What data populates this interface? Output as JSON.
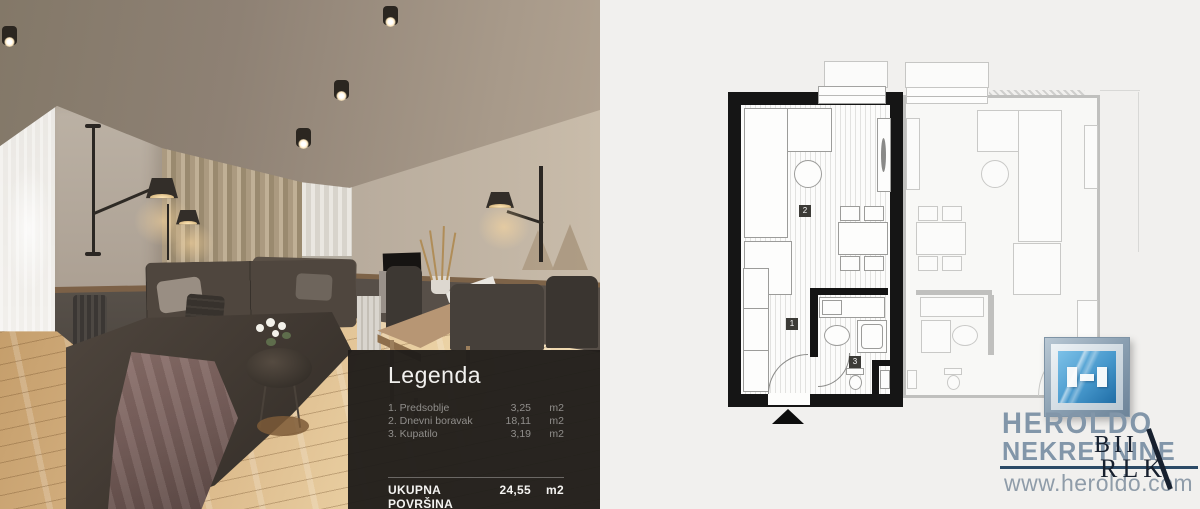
{
  "legend": {
    "title": "Legenda",
    "items": [
      {
        "name": "1. Predsoblje",
        "value": "3,25",
        "unit": "m2"
      },
      {
        "name": "2. Dnevni boravak",
        "value": "18,11",
        "unit": "m2"
      },
      {
        "name": "3. Kupatilo",
        "value": "3,19",
        "unit": "m2"
      }
    ],
    "total_label": "UKUPNA POVRŠINA",
    "total_value": "24,55",
    "total_unit": "m2"
  },
  "floorplan": {
    "labels": {
      "hallway": "1",
      "living": "2",
      "bathroom": "3"
    }
  },
  "brand": {
    "name_line1": "HEROLDO",
    "name_line2": "NEKRETNINE",
    "website": "www.heroldo.com",
    "watermark_line1": "BII",
    "watermark_line2": "RLK",
    "colors": {
      "logo_blue": "#2f7cb5",
      "steel_text": "#8296a9",
      "divider_navy": "#2c4a66"
    }
  }
}
